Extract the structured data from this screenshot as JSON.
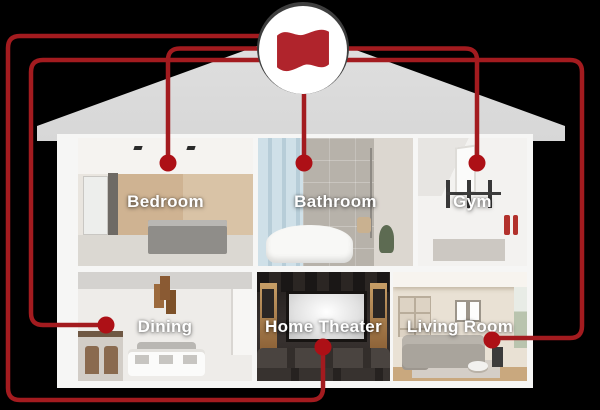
{
  "hub": {
    "icon": "flag-icon"
  },
  "rooms": [
    {
      "id": "bedroom",
      "label": "Bedroom"
    },
    {
      "id": "bathroom",
      "label": "Bathroom"
    },
    {
      "id": "gym",
      "label": "Gym"
    },
    {
      "id": "dining",
      "label": "Dining"
    },
    {
      "id": "home-theater",
      "label": "Home Theater"
    },
    {
      "id": "living-room",
      "label": "Living Room"
    }
  ],
  "colors": {
    "accent_red": "#a31b1f",
    "dot_red": "#ad1016",
    "flag_red": "#b0242c",
    "ring_gray": "#3e3e3e",
    "roof_gray": "#dadada",
    "house_white": "#f6f6f5"
  }
}
